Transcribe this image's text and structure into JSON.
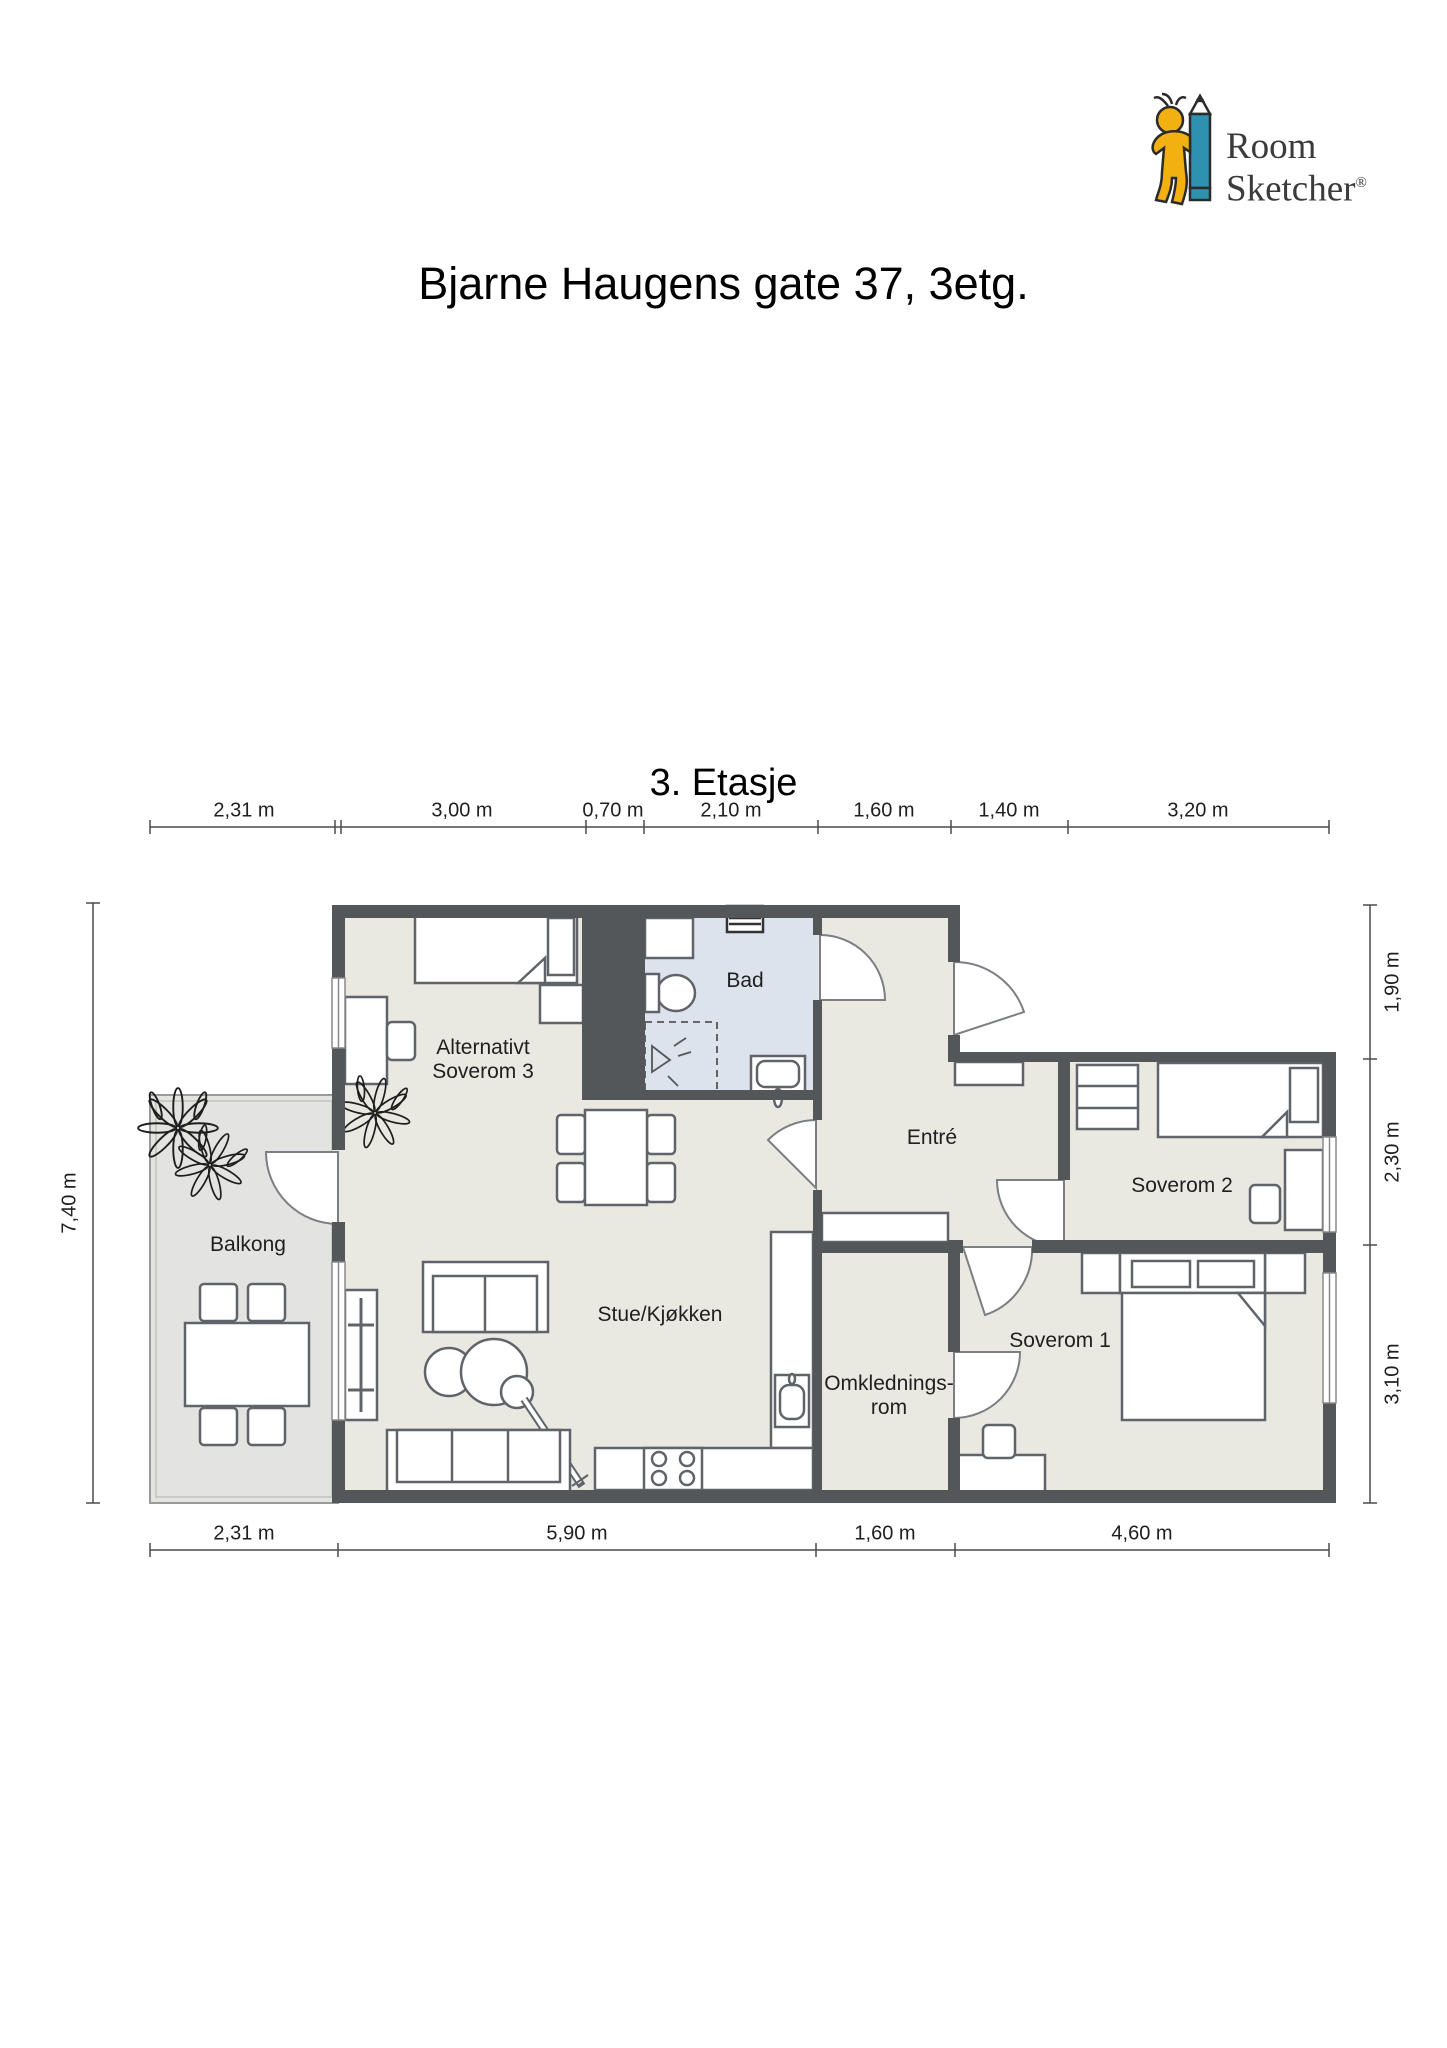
{
  "logo": {
    "word1": "Room",
    "word2": "Sketcher",
    "reg": "®"
  },
  "title": "Bjarne Haugens gate 37, 3etg.",
  "floor_label": "3. Etasje",
  "rooms": {
    "soverom3": "Alternativt\nSoverom 3",
    "bad": "Bad",
    "entre": "Entré",
    "soverom2": "Soverom 2",
    "soverom1": "Soverom 1",
    "omkledningsrom": "Omklednings-\nrom",
    "stue": "Stue/Kjøkken",
    "balkong": "Balkong"
  },
  "dimensions": {
    "top": [
      "2,31 m",
      "3,00 m",
      "0,70 m",
      "2,10 m",
      "1,60 m",
      "1,40 m",
      "3,20 m"
    ],
    "bottom": [
      "2,31 m",
      "5,90 m",
      "1,60 m",
      "4,60 m"
    ],
    "left": [
      "7,40 m"
    ],
    "right": [
      "1,90 m",
      "2,30 m",
      "3,10 m"
    ]
  },
  "colors": {
    "wall": "#53575a",
    "apartment_floor": "#e9e8e1",
    "bathroom_floor": "#dce3ec",
    "balcony_floor": "#e3e3e1",
    "furniture_stroke": "#60646a",
    "logo_yellow": "#f2b111",
    "logo_teal": "#2e92af",
    "logo_text": "#3b3b3b"
  }
}
